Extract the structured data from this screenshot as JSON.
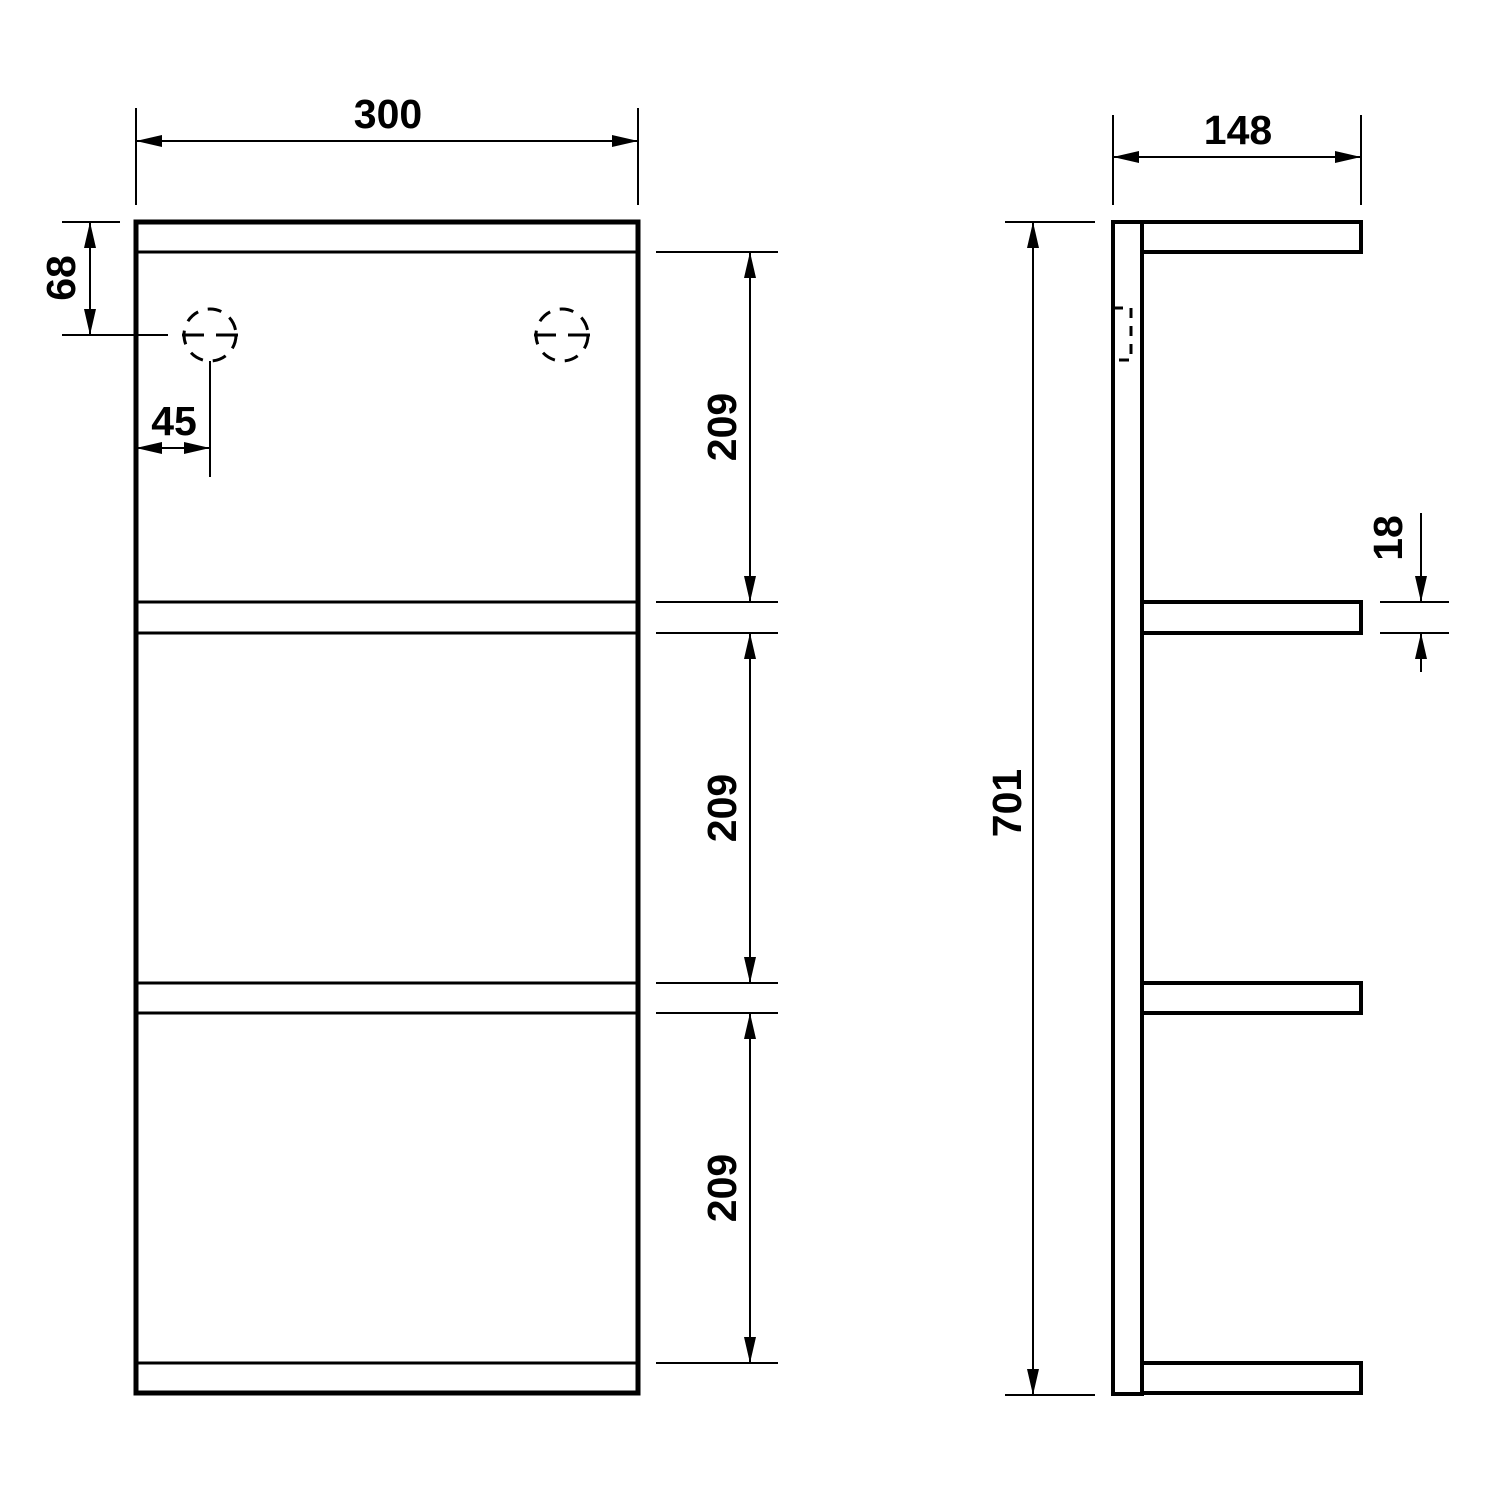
{
  "diagram": {
    "kind": "technical-drawing",
    "views": {
      "front": {
        "name": "front-view"
      },
      "side": {
        "name": "side-view"
      }
    }
  },
  "dimensions": {
    "front_width": "300",
    "hole_top_offset": "68",
    "hole_left_offset": "45",
    "shelf_spacing_top": "209",
    "shelf_spacing_middle": "209",
    "shelf_spacing_bottom": "209",
    "side_depth": "148",
    "overall_height": "701",
    "shelf_thickness": "18"
  },
  "colors": {
    "line": "#000000",
    "background": "#ffffff"
  }
}
